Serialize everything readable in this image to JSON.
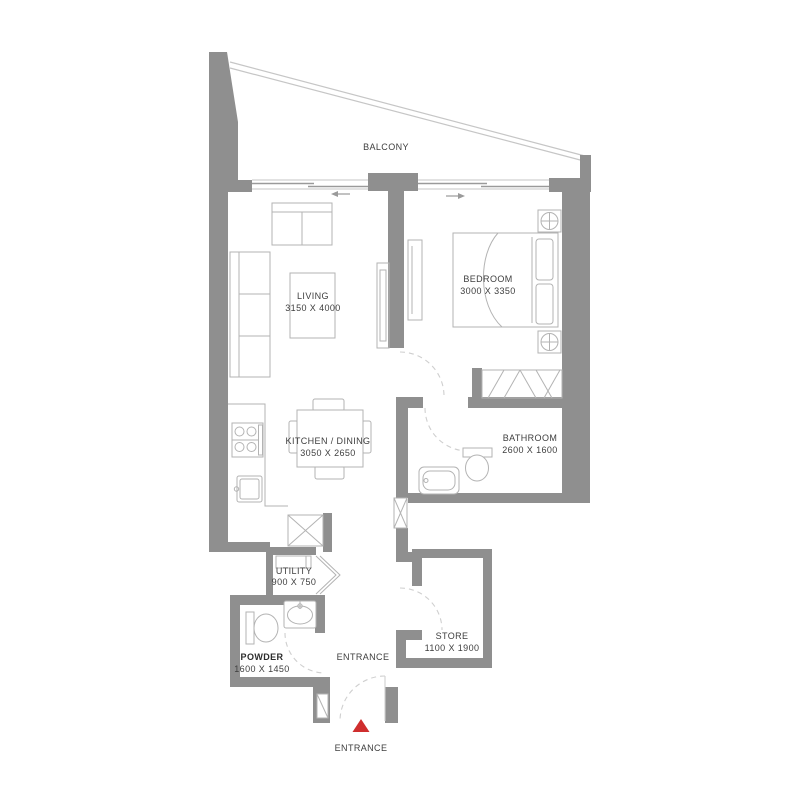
{
  "colors": {
    "background": "#ffffff",
    "wall": "#8f8f8f",
    "furniture_line": "#b3b3b3",
    "door_arc": "#cfcfcf",
    "railing": "#c6c6c6",
    "slider_line": "#9a9a9a",
    "label_text": "#3e3e3e",
    "entrance_marker": "#cf2e2e"
  },
  "rooms": {
    "balcony": {
      "name": "BALCONY"
    },
    "living": {
      "name": "LIVING",
      "dimensions": "3150 X 4000"
    },
    "bedroom": {
      "name": "BEDROOM",
      "dimensions": "3000 X 3350"
    },
    "kitchen_dining": {
      "name": "KITCHEN / DINING",
      "dimensions": "3050 X 2650"
    },
    "bathroom": {
      "name": "BATHROOM",
      "dimensions": "2600 X 1600"
    },
    "utility": {
      "name": "UTILITY",
      "dimensions": "900 X 750"
    },
    "powder": {
      "name": "POWDER",
      "dimensions": "1600 X 1450"
    },
    "store": {
      "name": "STORE",
      "dimensions": "1100 X 1900"
    },
    "entrance_hall": {
      "name": "ENTRANCE"
    },
    "entrance_door": {
      "name": "ENTRANCE"
    }
  }
}
